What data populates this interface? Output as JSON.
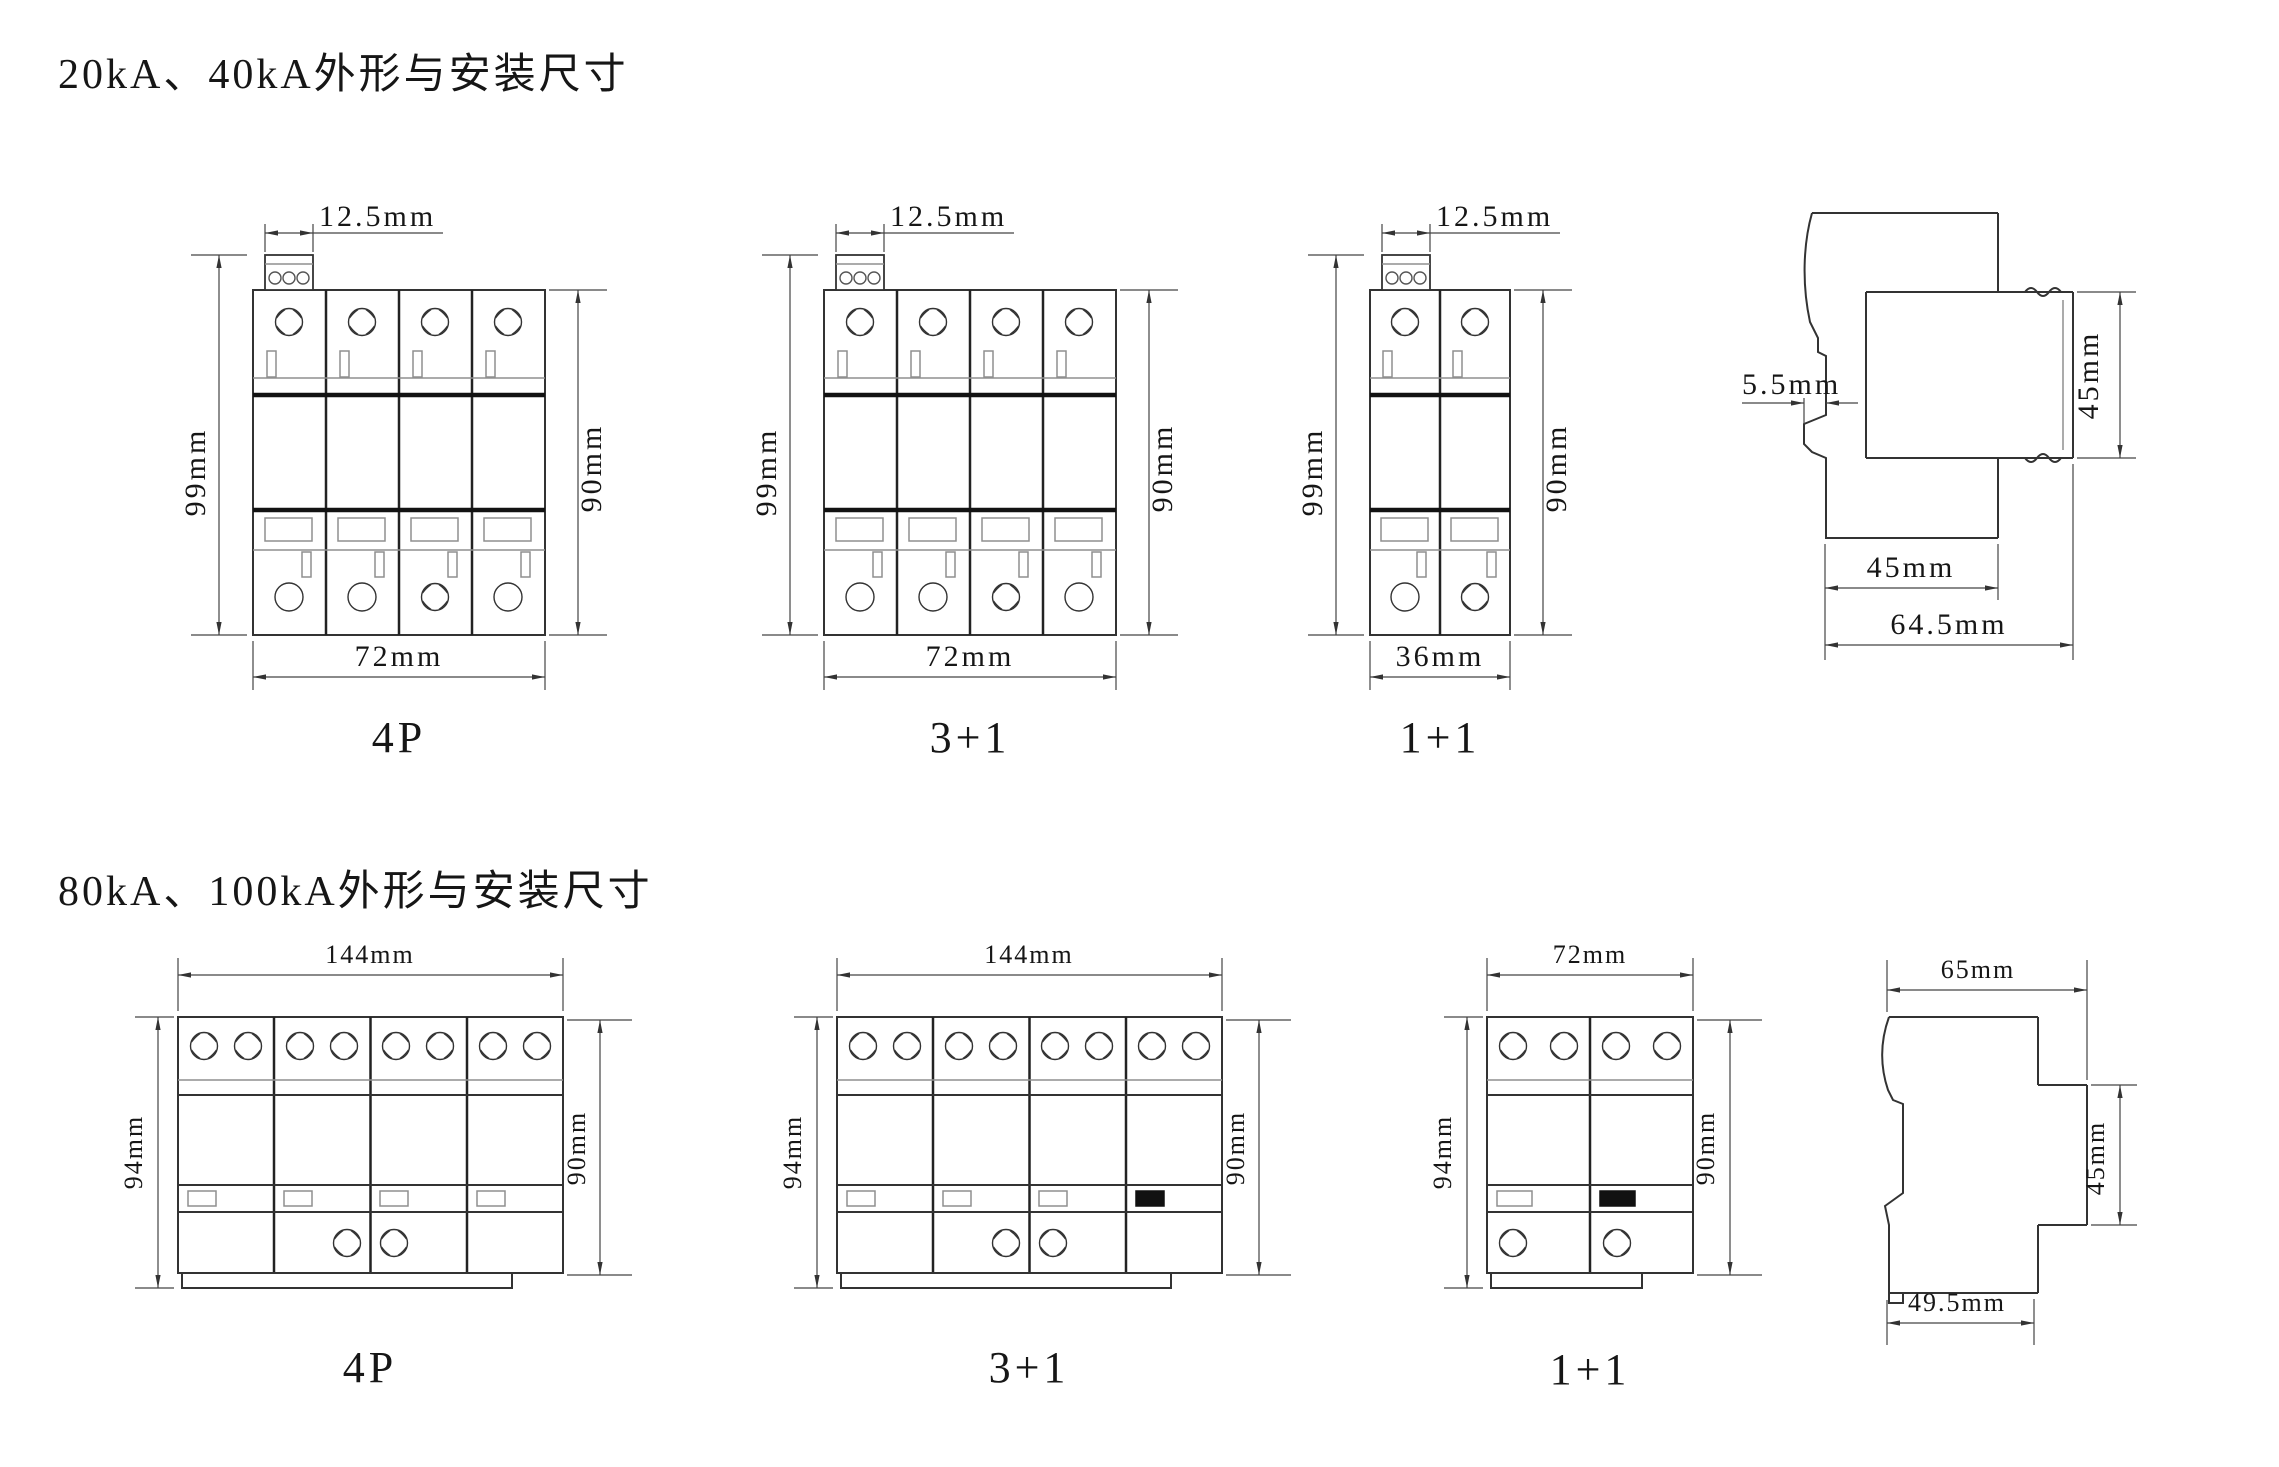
{
  "titles": {
    "small": "20kA、40kA外形与安装尺寸",
    "large": "80kA、100kA外形与安装尺寸"
  },
  "small": {
    "views": [
      {
        "name": "4P",
        "pitch": "12.5mm",
        "height_outer": "99mm",
        "height_body": "90mm",
        "width": "72mm"
      },
      {
        "name": "3+1",
        "pitch": "12.5mm",
        "height_outer": "99mm",
        "height_body": "90mm",
        "width": "72mm"
      },
      {
        "name": "1+1",
        "pitch": "12.5mm",
        "height_outer": "99mm",
        "height_body": "90mm",
        "width": "36mm"
      }
    ],
    "side": {
      "rail_offset": "5.5mm",
      "front_height": "45mm",
      "mount_depth": "45mm",
      "total_depth": "64.5mm"
    }
  },
  "large": {
    "views": [
      {
        "name": "4P",
        "width": "144mm",
        "height_outer": "94mm",
        "height_body": "90mm"
      },
      {
        "name": "3+1",
        "width": "144mm",
        "height_outer": "94mm",
        "height_body": "90mm"
      },
      {
        "name": "1+1",
        "width": "72mm",
        "height_outer": "94mm",
        "height_body": "90mm"
      }
    ],
    "side": {
      "total_depth": "65mm",
      "front_height": "45mm",
      "base_depth": "49.5mm"
    }
  }
}
